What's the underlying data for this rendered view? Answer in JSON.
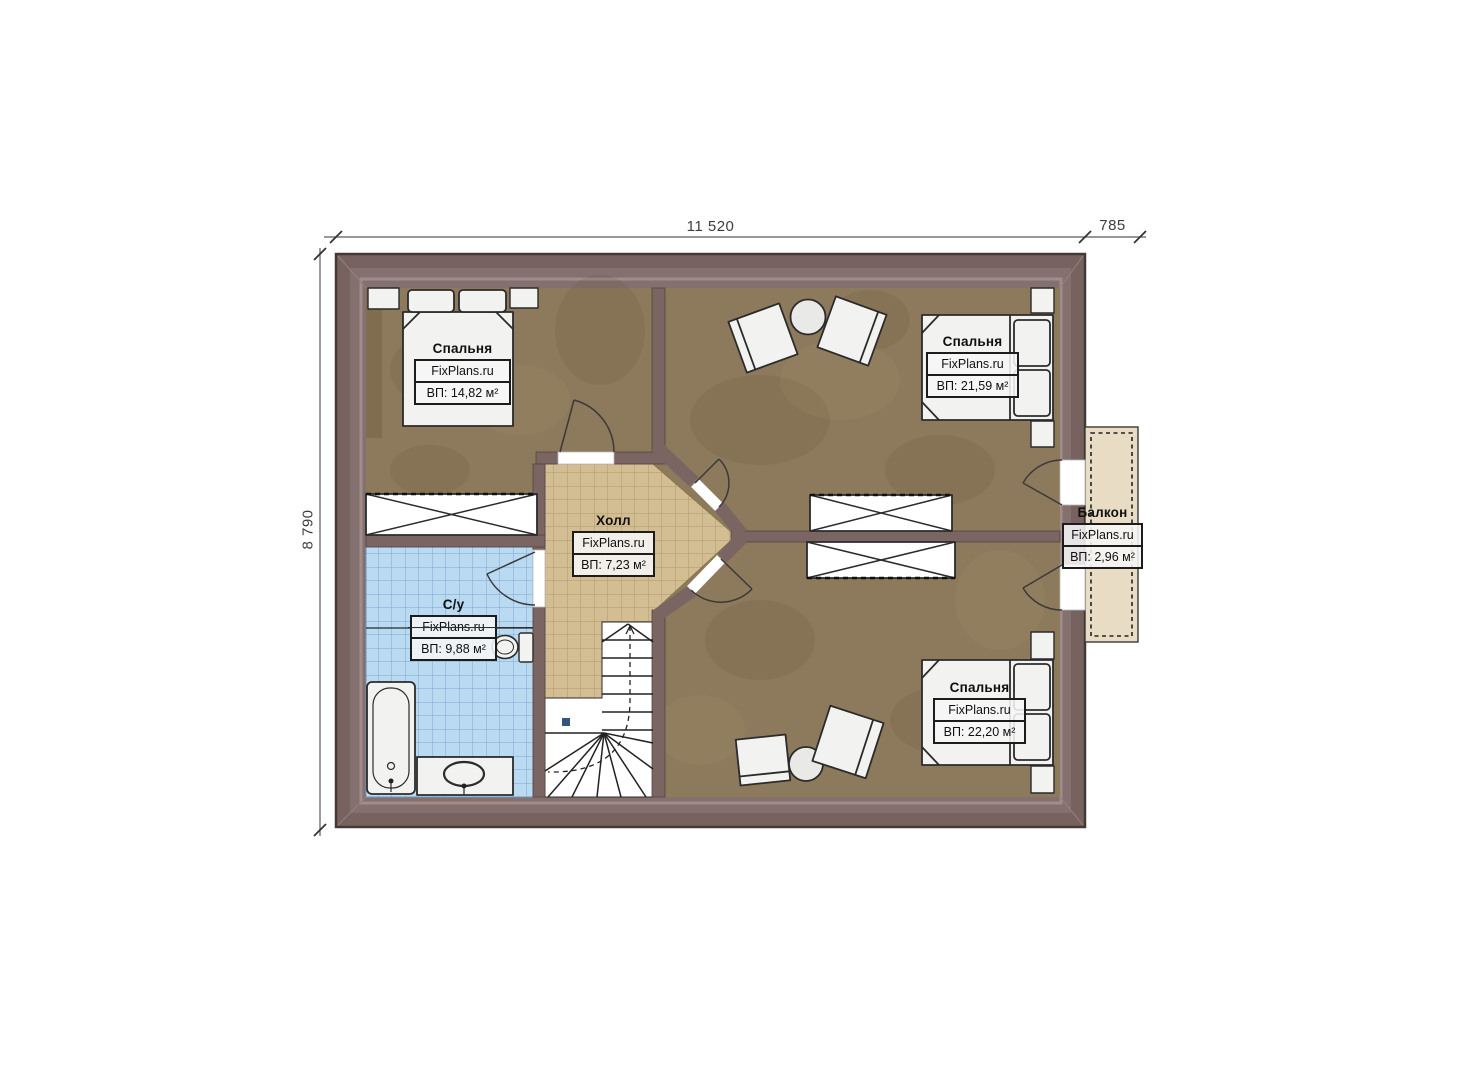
{
  "plan_type": "floor-plan",
  "brand": "FixPlans.ru",
  "dimensions": {
    "top_width": "11 520",
    "balcony_width": "785",
    "left_height": "8 790"
  },
  "rooms": [
    {
      "id": "bedroom-top-left",
      "name": "Спальня",
      "brand": "FixPlans.ru",
      "area": "ВП: 14,82 м²"
    },
    {
      "id": "bedroom-top-right",
      "name": "Спальня",
      "brand": "FixPlans.ru",
      "area": "ВП: 21,59 м²"
    },
    {
      "id": "hall",
      "name": "Холл",
      "brand": "FixPlans.ru",
      "area": "ВП: 7,23 м²"
    },
    {
      "id": "bathroom",
      "name": "С/у",
      "brand": "FixPlans.ru",
      "area": "ВП: 9,88 м²"
    },
    {
      "id": "bedroom-bottom-right",
      "name": "Спальня",
      "brand": "FixPlans.ru",
      "area": "ВП: 22,20 м²"
    },
    {
      "id": "balcony",
      "name": "Балкон",
      "brand": "FixPlans.ru",
      "area": "ВП: 2,96 м²"
    }
  ],
  "colors": {
    "exterior_wall": "#7a6563",
    "wall_inner_band": "#84706e",
    "wall_highlight": "#a08c8a",
    "bedroom_floor": "#8d795b",
    "hall_tile": "#d3bd92",
    "bath_tile": "#badaf2",
    "balcony_floor": "#e8dcc4",
    "furniture": "#f2f2f0",
    "outline": "#2b2b2b"
  }
}
